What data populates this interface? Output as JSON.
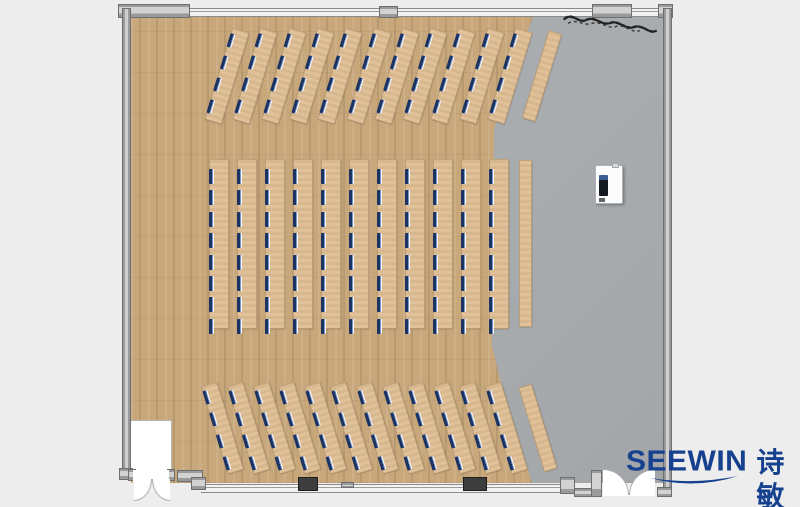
{
  "scene": {
    "type": "floor-plan-render",
    "description": "Top-down rendering of a large training room / classroom furniture layout"
  },
  "branding": {
    "logo_text": "SEEWIN",
    "logo_text_cn": "诗敏",
    "logo_color": "#16418f"
  },
  "palette": {
    "background": "#ededed",
    "wood_floor": "#c8a77b",
    "gray_floor": "#a8acaf",
    "desk": "#debd93",
    "seat": "#1b3363",
    "wall": "#c9c9c9",
    "column": "#3d3d3d",
    "door": "#ffffff",
    "logo_blue": "#16418f"
  },
  "desk_groups": [
    {
      "id": "top",
      "orientation": "angled",
      "angle_deg": 17,
      "desk_count": 11,
      "seats_per_desk": 4,
      "blank_desk_count": 1,
      "total_seats": 44
    },
    {
      "id": "middle",
      "orientation": "vertical",
      "angle_deg": 0,
      "desk_count": 11,
      "seats_per_desk": 8,
      "blank_desk_count": 1,
      "total_seats": 88
    },
    {
      "id": "bottom",
      "orientation": "angled",
      "angle_deg": -17,
      "desk_count": 12,
      "seats_per_desk": 4,
      "blank_desk_count": 1,
      "total_seats": 48
    }
  ],
  "totals": {
    "desks": 34,
    "blank_side_tables": 3,
    "seats": 180
  },
  "room": {
    "floors": {
      "left": "wood plank flooring",
      "right": "gray hard flooring"
    },
    "walls": {
      "top": "window wall with three solid segments",
      "left": "solid wall",
      "right": "solid wall",
      "bottom": "window wall with two dark columns"
    },
    "doors": [
      {
        "name": "bottom-left double door",
        "swing": "outward"
      },
      {
        "name": "bottom-right double door",
        "swing": "outward"
      }
    ],
    "features": [
      {
        "name": "entrance vestibule",
        "location": "bottom-left corner"
      },
      {
        "name": "podium",
        "location": "right side on gray floor"
      },
      {
        "name": "plant scribble",
        "location": "top-right corner"
      }
    ]
  }
}
